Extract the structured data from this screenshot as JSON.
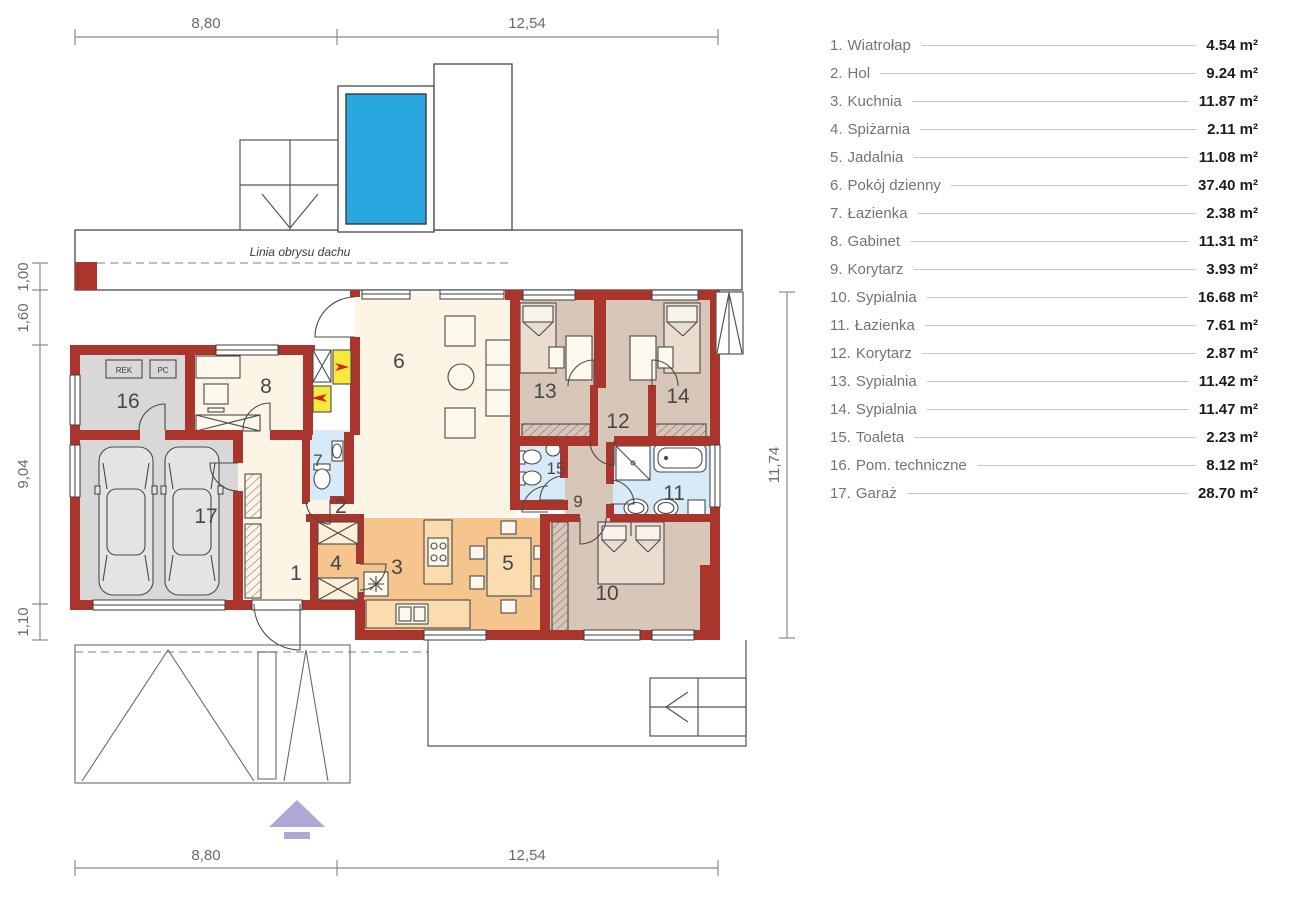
{
  "legend": {
    "items": [
      {
        "num": "1.",
        "name": "Wiatrołap",
        "area": "4.54 m²"
      },
      {
        "num": "2.",
        "name": "Hol",
        "area": "9.24 m²"
      },
      {
        "num": "3.",
        "name": "Kuchnia",
        "area": "11.87 m²"
      },
      {
        "num": "4.",
        "name": "Spiżarnia",
        "area": "2.11 m²"
      },
      {
        "num": "5.",
        "name": "Jadalnia",
        "area": "11.08 m²"
      },
      {
        "num": "6.",
        "name": "Pokój dzienny",
        "area": "37.40 m²"
      },
      {
        "num": "7.",
        "name": "Łazienka",
        "area": "2.38 m²"
      },
      {
        "num": "8.",
        "name": "Gabinet",
        "area": "11.31 m²"
      },
      {
        "num": "9.",
        "name": "Korytarz",
        "area": "3.93 m²"
      },
      {
        "num": "10.",
        "name": "Sypialnia",
        "area": "16.68 m²"
      },
      {
        "num": "11.",
        "name": "Łazienka",
        "area": "7.61 m²"
      },
      {
        "num": "12.",
        "name": "Korytarz",
        "area": "2.87 m²"
      },
      {
        "num": "13.",
        "name": "Sypialnia",
        "area": "11.42 m²"
      },
      {
        "num": "14.",
        "name": "Sypialnia",
        "area": "11.47 m²"
      },
      {
        "num": "15.",
        "name": "Toaleta",
        "area": "2.23 m²"
      },
      {
        "num": "16.",
        "name": "Pom. techniczne",
        "area": "8.12 m²"
      },
      {
        "num": "17.",
        "name": "Garaż",
        "area": "28.70 m²"
      }
    ]
  },
  "dimensions": {
    "top": [
      "8,80",
      "12,54"
    ],
    "bottom": [
      "8,80",
      "12,54"
    ],
    "left": [
      "1,00",
      "1,60",
      "9,04",
      "1,10"
    ],
    "right": [
      "11,74"
    ]
  },
  "plan": {
    "roof_line_label": "Linia obrysu dachu",
    "room_numbers": [
      "1",
      "2",
      "3",
      "4",
      "5",
      "6",
      "7",
      "8",
      "9",
      "10",
      "11",
      "12",
      "13",
      "14",
      "15",
      "16",
      "17"
    ],
    "equipment_labels": {
      "rek": "REK",
      "pc": "PC"
    }
  },
  "colors": {
    "wall": "#a9352c",
    "room_living_cream": "#fcf4e4",
    "room_kitchen_orange": "#f6c48d",
    "room_bedroom_tan": "#d8c6b8",
    "room_bath_blue": "#d6eaf7",
    "room_garage_gray": "#d8d8d8",
    "pool_blue": "#29a8e0",
    "vent_yellow": "#f7e93c",
    "vent_arrow_red": "#d42020",
    "entrance_arrow_purple": "#aea7d8"
  }
}
